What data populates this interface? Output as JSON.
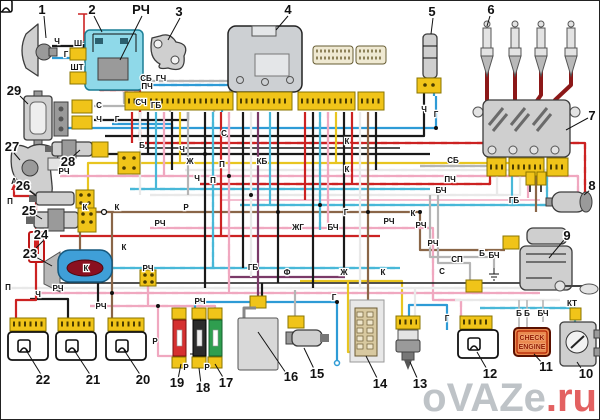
{
  "diagram": {
    "watermark": {
      "name": "oVAZe",
      "tld": ".ru"
    },
    "check_engine_lamp": {
      "line1": "CHECK",
      "line2": "ENGINE"
    },
    "colors": {
      "connector_yellow": "#f0c419",
      "relay_cyan": "#8fd9e9",
      "wire_red": "#cc2222",
      "wire_black": "#1a1a1a",
      "wire_blue": "#2e9bd6",
      "wire_cyan": "#49b8d8",
      "wire_pink": "#f0a8c0",
      "wire_yellow": "#e8c520",
      "wire_brown": "#8a6648",
      "wire_gray": "#b5b5b5",
      "wire_purple": "#7a3a68",
      "wire_white": "#e9e9e9",
      "ht_lead_dark_red": "#8c1818",
      "check_engine_bg": "#ea8a50",
      "fuse_red": "#d53030",
      "fuse_black": "#2b2b2b",
      "fuse_green": "#2f9e4f",
      "pump_blue": "#3f9fd8",
      "watermark_gray": "#b8bdc2",
      "watermark_red": "#e05050"
    },
    "callouts": [
      {
        "t": "1",
        "x": 42,
        "y": 14
      },
      {
        "t": "2",
        "x": 92,
        "y": 14
      },
      {
        "t": "РЧ",
        "x": 141,
        "y": 14
      },
      {
        "t": "3",
        "x": 179,
        "y": 16
      },
      {
        "t": "4",
        "x": 288,
        "y": 14
      },
      {
        "t": "5",
        "x": 432,
        "y": 16
      },
      {
        "t": "6",
        "x": 491,
        "y": 14
      },
      {
        "t": "7",
        "x": 592,
        "y": 120
      },
      {
        "t": "8",
        "x": 592,
        "y": 190
      },
      {
        "t": "9",
        "x": 567,
        "y": 240
      },
      {
        "t": "10",
        "x": 586,
        "y": 378
      },
      {
        "t": "11",
        "x": 546,
        "y": 371
      },
      {
        "t": "12",
        "x": 490,
        "y": 378
      },
      {
        "t": "13",
        "x": 420,
        "y": 388
      },
      {
        "t": "14",
        "x": 380,
        "y": 388
      },
      {
        "t": "15",
        "x": 317,
        "y": 378
      },
      {
        "t": "16",
        "x": 291,
        "y": 381
      },
      {
        "t": "17",
        "x": 226,
        "y": 387
      },
      {
        "t": "18",
        "x": 203,
        "y": 392
      },
      {
        "t": "19",
        "x": 177,
        "y": 387
      },
      {
        "t": "20",
        "x": 143,
        "y": 384
      },
      {
        "t": "21",
        "x": 93,
        "y": 384
      },
      {
        "t": "22",
        "x": 43,
        "y": 384
      },
      {
        "t": "23",
        "x": 30,
        "y": 258
      },
      {
        "t": "24",
        "x": 41,
        "y": 239
      },
      {
        "t": "25",
        "x": 29,
        "y": 215
      },
      {
        "t": "26",
        "x": 23,
        "y": 190
      },
      {
        "t": "27",
        "x": 12,
        "y": 151
      },
      {
        "t": "28",
        "x": 68,
        "y": 166
      },
      {
        "t": "29",
        "x": 14,
        "y": 95
      }
    ],
    "wire_labels": [
      {
        "t": "Ч",
        "x": 57,
        "y": 44
      },
      {
        "t": "Г",
        "x": 66,
        "y": 57
      },
      {
        "t": "Ш",
        "x": 78,
        "y": 46
      },
      {
        "t": "ШТ",
        "x": 77,
        "y": 70
      },
      {
        "t": "ПЧ",
        "x": 147,
        "y": 89
      },
      {
        "t": "С",
        "x": 99,
        "y": 108
      },
      {
        "t": "Ч",
        "x": 99,
        "y": 122
      },
      {
        "t": "Г",
        "x": 117,
        "y": 122
      },
      {
        "t": "СБ",
        "x": 146,
        "y": 81
      },
      {
        "t": "ГЧ",
        "x": 161,
        "y": 81
      },
      {
        "t": "СЧ",
        "x": 141,
        "y": 105
      },
      {
        "t": "ГБ",
        "x": 156,
        "y": 108
      },
      {
        "t": "Б",
        "x": 142,
        "y": 148
      },
      {
        "t": "Ч",
        "x": 182,
        "y": 152
      },
      {
        "t": "Ж",
        "x": 190,
        "y": 164
      },
      {
        "t": "РЧ",
        "x": 64,
        "y": 174
      },
      {
        "t": "А",
        "x": 14,
        "y": 184
      },
      {
        "t": "Ч",
        "x": 197,
        "y": 181
      },
      {
        "t": "К",
        "x": 85,
        "y": 210
      },
      {
        "t": "К",
        "x": 117,
        "y": 210
      },
      {
        "t": "Р",
        "x": 186,
        "y": 210
      },
      {
        "t": "РЧ",
        "x": 160,
        "y": 226
      },
      {
        "t": "К",
        "x": 124,
        "y": 250
      },
      {
        "t": "П",
        "x": 10,
        "y": 204
      },
      {
        "t": "П",
        "x": 8,
        "y": 290
      },
      {
        "t": "К",
        "x": 86,
        "y": 271
      },
      {
        "t": "РЧ",
        "x": 148,
        "y": 271
      },
      {
        "t": "Ч",
        "x": 38,
        "y": 297
      },
      {
        "t": "РЧ",
        "x": 58,
        "y": 291
      },
      {
        "t": "РЧ",
        "x": 101,
        "y": 309
      },
      {
        "t": "Р",
        "x": 155,
        "y": 344
      },
      {
        "t": "РЧ",
        "x": 200,
        "y": 304
      },
      {
        "t": "С",
        "x": 224,
        "y": 136
      },
      {
        "t": "П",
        "x": 222,
        "y": 167
      },
      {
        "t": "П",
        "x": 213,
        "y": 183
      },
      {
        "t": "КБ",
        "x": 262,
        "y": 164
      },
      {
        "t": "К",
        "x": 347,
        "y": 144
      },
      {
        "t": "К",
        "x": 347,
        "y": 172
      },
      {
        "t": "Г",
        "x": 346,
        "y": 215
      },
      {
        "t": "РЧ",
        "x": 389,
        "y": 224
      },
      {
        "t": "ЖГ",
        "x": 298,
        "y": 230
      },
      {
        "t": "БЧ",
        "x": 333,
        "y": 230
      },
      {
        "t": "ГБ",
        "x": 253,
        "y": 270
      },
      {
        "t": "Ф",
        "x": 287,
        "y": 275
      },
      {
        "t": "Ж",
        "x": 344,
        "y": 275
      },
      {
        "t": "К",
        "x": 383,
        "y": 275
      },
      {
        "t": "Ч",
        "x": 424,
        "y": 112
      },
      {
        "t": "Г",
        "x": 436,
        "y": 117
      },
      {
        "t": "СБ",
        "x": 453,
        "y": 163
      },
      {
        "t": "ПЧ",
        "x": 450,
        "y": 182
      },
      {
        "t": "БЧ",
        "x": 441,
        "y": 193
      },
      {
        "t": "ГБ",
        "x": 514,
        "y": 203
      },
      {
        "t": "К",
        "x": 413,
        "y": 216
      },
      {
        "t": "РЧ",
        "x": 421,
        "y": 228
      },
      {
        "t": "РЧ",
        "x": 433,
        "y": 246
      },
      {
        "t": "СП",
        "x": 457,
        "y": 262
      },
      {
        "t": "С",
        "x": 442,
        "y": 274
      },
      {
        "t": "Б",
        "x": 482,
        "y": 256
      },
      {
        "t": "БЧ",
        "x": 494,
        "y": 258
      },
      {
        "t": "Г",
        "x": 334,
        "y": 300
      },
      {
        "t": "Г",
        "x": 447,
        "y": 321
      },
      {
        "t": "КТ",
        "x": 572,
        "y": 306
      },
      {
        "t": "Б",
        "x": 519,
        "y": 316
      },
      {
        "t": "Б",
        "x": 527,
        "y": 316
      },
      {
        "t": "БЧ",
        "x": 543,
        "y": 316
      },
      {
        "t": "Р",
        "x": 186,
        "y": 370
      },
      {
        "t": "Р",
        "x": 207,
        "y": 370
      }
    ]
  }
}
